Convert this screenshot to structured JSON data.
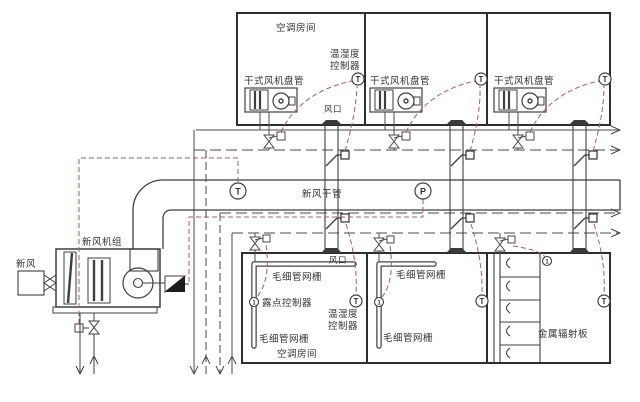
{
  "diagram": {
    "labels": {
      "room_top": "空调房间",
      "hum_ctrl_1": "温湿度",
      "hum_ctrl_2": "控制器",
      "dry_fcu": "干式风机盘管",
      "air_outlet": "风口",
      "main_duct": "新风干管",
      "ahu": "新风机组",
      "fresh_air": "新风",
      "capillary_mat": "毛细管网栅",
      "dew_ctrl": "露点控制器",
      "room_bottom": "空调房间",
      "radiant_panel": "金属辐射板"
    },
    "sensors": {
      "t": "T",
      "p": "P",
      "dew": "1"
    },
    "colors": {
      "line": "#3f3f3f",
      "wall": "#2e2e2e",
      "control_wire": "#b25858",
      "background": "#ffffff"
    }
  }
}
